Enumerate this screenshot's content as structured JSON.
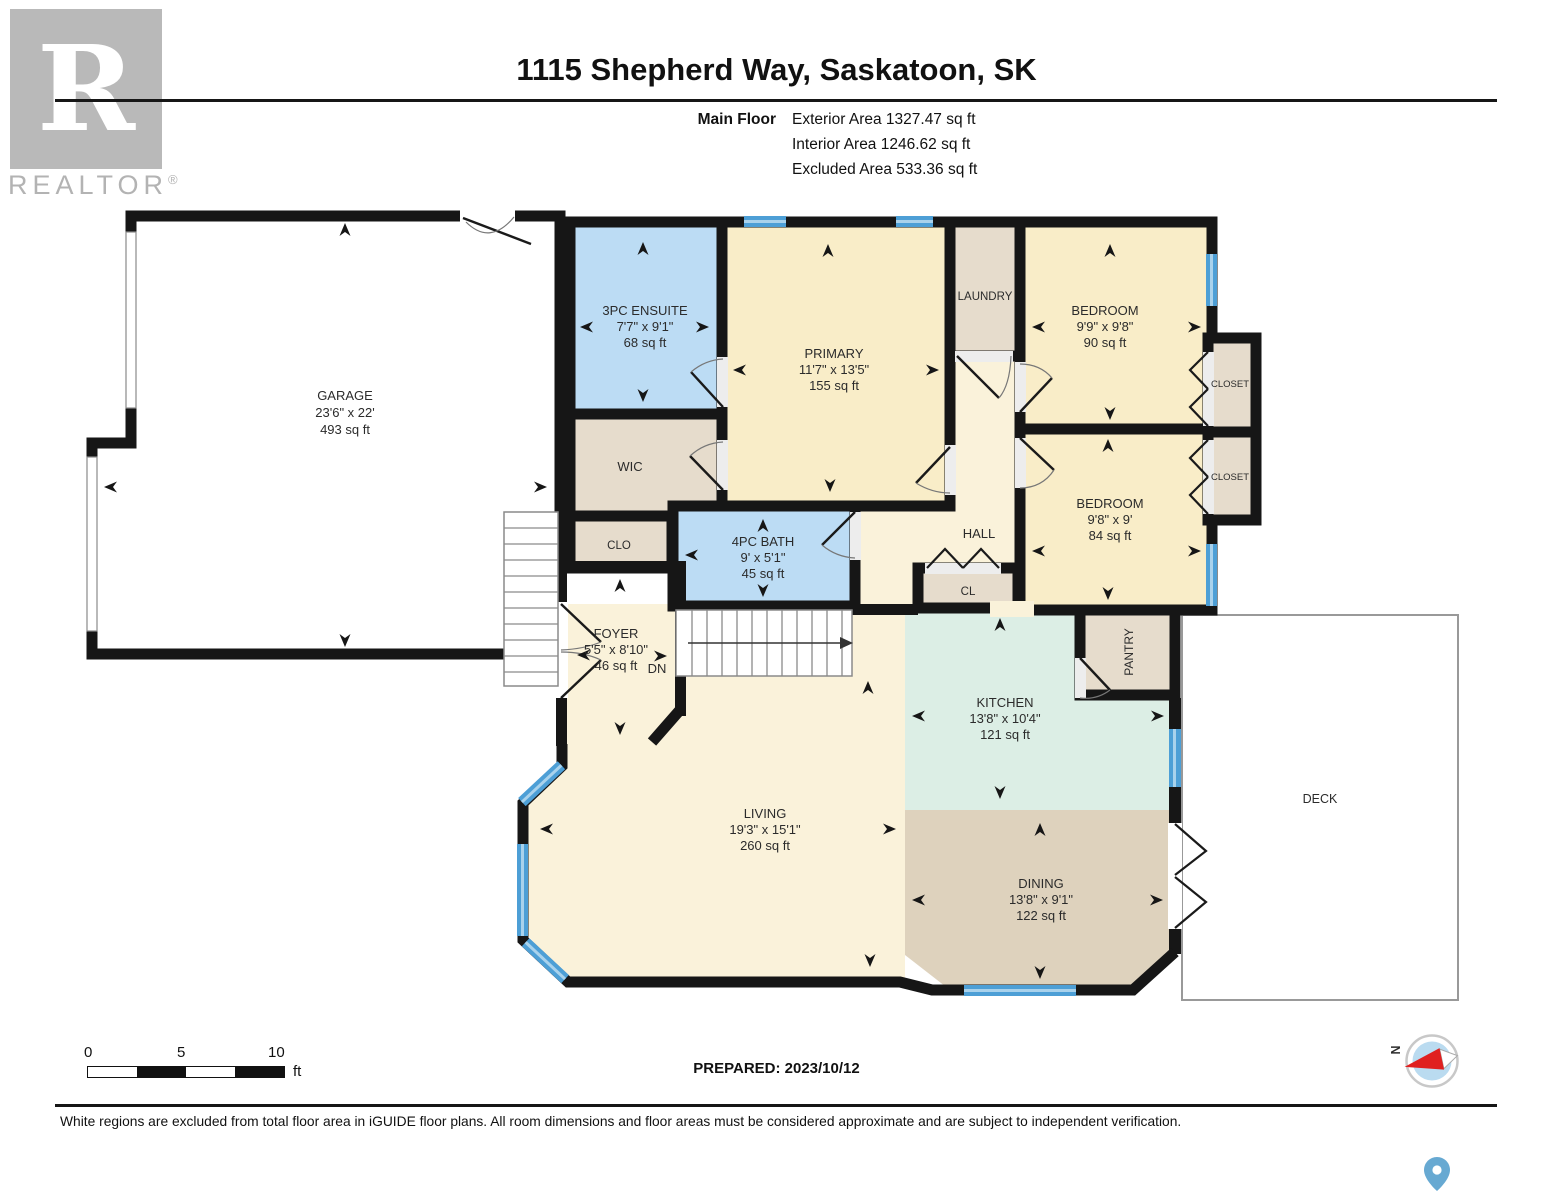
{
  "header": {
    "title": "1115 Shepherd Way, Saskatoon, SK",
    "floor_label": "Main Floor",
    "stats": {
      "exterior": "Exterior Area 1327.47 sq ft",
      "interior": "Interior Area 1246.62 sq ft",
      "excluded": "Excluded Area 533.36 sq ft"
    },
    "logo": {
      "letter": "R",
      "brand": "REALTOR",
      "registered": "®"
    }
  },
  "rooms": {
    "garage": {
      "name": "GARAGE",
      "dims": "23'6\" x 22'",
      "area": "493 sq ft"
    },
    "ensuite": {
      "name": "3PC ENSUITE",
      "dims": "7'7\" x 9'1\"",
      "area": "68 sq ft"
    },
    "wic": {
      "name": "WIC"
    },
    "clo": {
      "name": "CLO"
    },
    "bath": {
      "name": "4PC BATH",
      "dims": "9' x 5'1\"",
      "area": "45 sq ft"
    },
    "primary": {
      "name": "PRIMARY",
      "dims": "11'7\" x 13'5\"",
      "area": "155 sq ft"
    },
    "laundry": {
      "name": "LAUNDRY"
    },
    "bedroom1": {
      "name": "BEDROOM",
      "dims": "9'9\" x 9'8\"",
      "area": "90 sq ft"
    },
    "closet1": {
      "name": "CLOSET"
    },
    "bedroom2": {
      "name": "BEDROOM",
      "dims": "9'8\" x 9'",
      "area": "84 sq ft"
    },
    "closet2": {
      "name": "CLOSET"
    },
    "hall": {
      "name": "HALL"
    },
    "cl": {
      "name": "CL"
    },
    "pantry": {
      "name": "PANTRY"
    },
    "kitchen": {
      "name": "KITCHEN",
      "dims": "13'8\" x 10'4\"",
      "area": "121 sq ft"
    },
    "dining": {
      "name": "DINING",
      "dims": "13'8\" x 9'1\"",
      "area": "122 sq ft"
    },
    "living": {
      "name": "LIVING",
      "dims": "19'3\" x 15'1\"",
      "area": "260 sq ft"
    },
    "foyer": {
      "name": "FOYER",
      "dims": "5'5\" x 8'10\"",
      "area": "46 sq ft"
    },
    "deck": {
      "name": "DECK"
    }
  },
  "stairs": {
    "down_label": "DN"
  },
  "scale_bar": {
    "tick0": "0",
    "tick5": "5",
    "tick10": "10",
    "unit": "ft"
  },
  "prepared": "PREPARED: 2023/10/12",
  "compass": {
    "north_label": "N"
  },
  "footer": {
    "disclaimer": "White regions are excluded from total floor area in iGUIDE floor plans. All room dimensions and floor areas must be considered approximate and are subject to independent verification."
  },
  "colors": {
    "wall": "#161616",
    "bedroom_fill": "#f9edc8",
    "bath_fill": "#bcdcf4",
    "closet_fill": "#e6dccc",
    "kitchen_fill": "#dceee5",
    "dining_fill": "#ded2bd",
    "living_fill": "#faf2da",
    "foyer_fill": "#dbdbdb",
    "window_blue": "#4d9fd6",
    "compass_red": "#e02020",
    "pin_blue": "#67a9d2",
    "logo_gray": "#b9b9b9"
  }
}
